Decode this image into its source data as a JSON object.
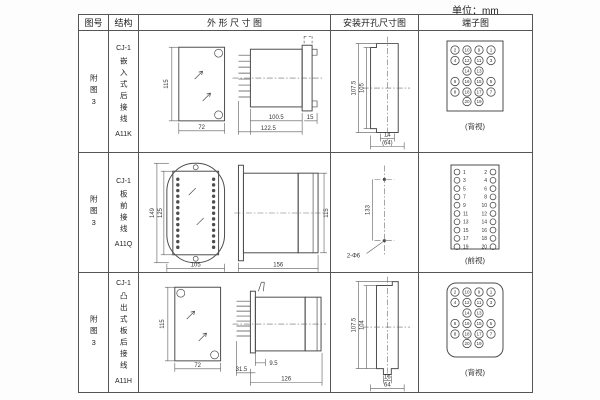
{
  "page": {
    "unit_label": "单位：mm"
  },
  "table": {
    "headers": {
      "fig_no": "图号",
      "structure": "结构",
      "outline": "外 形 尺 寸 图",
      "mounting": "安装开孔尺寸图",
      "terminal": "端子图"
    }
  },
  "rows": [
    {
      "fig_no": "附图3",
      "structure": {
        "title": "CJ-1",
        "desc": "嵌入式后接线",
        "code": "A11K"
      },
      "outline": {
        "front_h": "115",
        "front_w": "72",
        "side_d1": "100.5",
        "side_d2": "122.5",
        "side_d3": "15"
      },
      "mounting": {
        "v1": "107.5",
        "v2": "105",
        "h1": "14",
        "h2": "(64)"
      },
      "terminal": {
        "type": "back20",
        "caption": "(背视)",
        "outer_left": [
          "2",
          "4",
          "6",
          "8"
        ],
        "mid_left": [
          "10",
          "12",
          "14",
          "16",
          "18",
          "20"
        ],
        "mid_right": [
          "9",
          "11",
          "13",
          "15",
          "17",
          "19"
        ],
        "outer_right": [
          "1",
          "3",
          "5",
          "7"
        ]
      }
    },
    {
      "fig_no": "附图3",
      "structure": {
        "title": "CJ-1",
        "desc": "板前接线",
        "code": "A11Q"
      },
      "outline": {
        "front_h1": "149",
        "front_h2": "125",
        "front_w": "105",
        "side_l": "156",
        "side_h": "115"
      },
      "mounting": {
        "v1": "133",
        "hole_label": "2-Φ6"
      },
      "terminal": {
        "type": "front20",
        "caption": "(前视)",
        "left": [
          "1",
          "3",
          "5",
          "7",
          "9",
          "11",
          "13",
          "15",
          "17",
          "19"
        ],
        "right": [
          "2",
          "4",
          "6",
          "8",
          "10",
          "12",
          "14",
          "16",
          "18",
          "20"
        ]
      }
    },
    {
      "fig_no": "附图3",
      "structure": {
        "title": "CJ-1",
        "desc": "凸出式板后接线",
        "code": "A11H"
      },
      "outline": {
        "front_h": "115",
        "front_w": "72",
        "side_d1": "31.5",
        "side_d2": "9.5",
        "side_d3": "126"
      },
      "mounting": {
        "v1": "107.5",
        "v2": "104",
        "h1": "16",
        "h2": "64"
      },
      "terminal": {
        "type": "back20",
        "caption": "(背视)",
        "outer_left": [
          "2",
          "4",
          "6",
          "8"
        ],
        "mid_left": [
          "10",
          "12",
          "14",
          "16",
          "18",
          "20"
        ],
        "mid_right": [
          "9",
          "11",
          "13",
          "15",
          "17",
          "19"
        ],
        "outer_right": [
          "1",
          "3",
          "5",
          "7"
        ]
      }
    }
  ]
}
